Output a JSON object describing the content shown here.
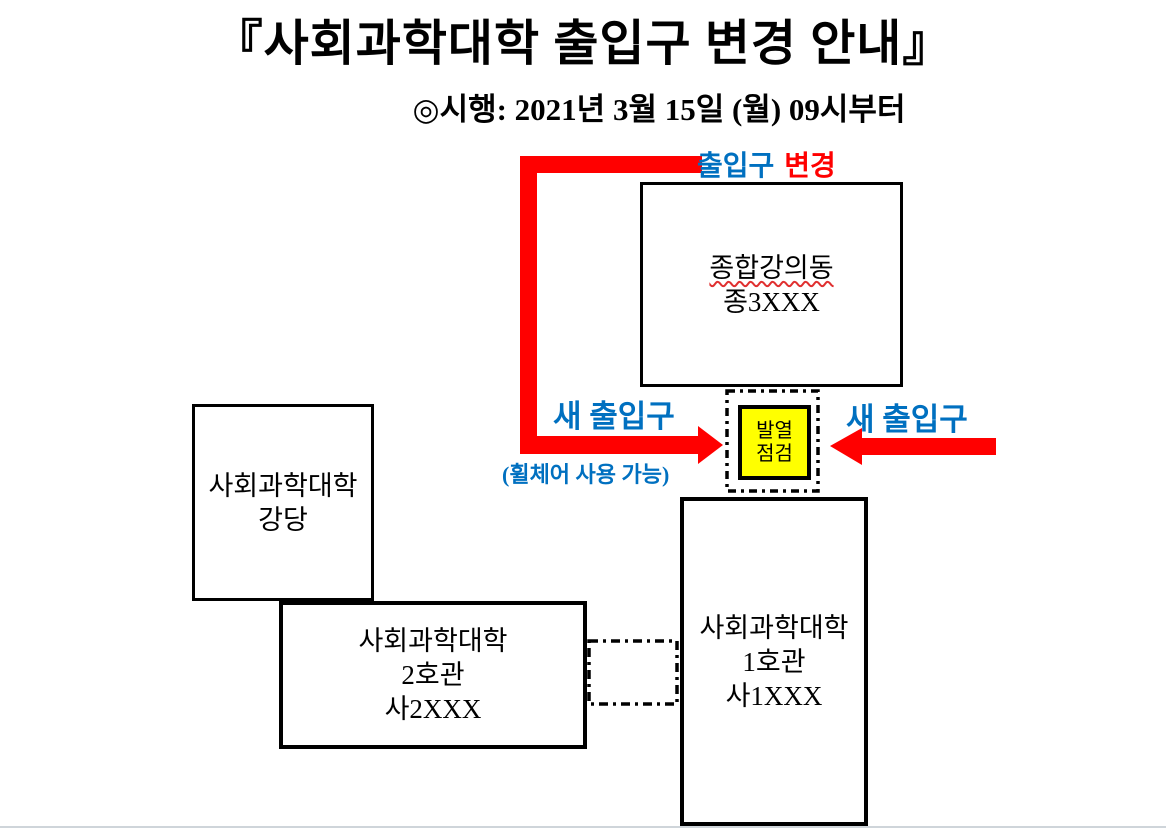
{
  "title": "『사회과학대학 출입구 변경 안내』",
  "subtitle": "◎시행: 2021년 3월 15일 (월) 09시부터",
  "labels": {
    "entrance_change_blue": "출입구",
    "entrance_change_red": "변경",
    "new_entrance_left": "새 출입구",
    "new_entrance_right": "새 출입구",
    "wheelchair_note": "(휠체어 사용 가능)"
  },
  "buildings": {
    "lecture_hall": {
      "name": "종합강의동",
      "code": "종3XXX"
    },
    "auditorium": {
      "line1": "사회과학대학",
      "line2": "강당"
    },
    "building2": {
      "line1": "사회과학대학",
      "line2": "2호관",
      "line3": "사2XXX"
    },
    "building1": {
      "line1": "사회과학대학",
      "line2": "1호관",
      "line3": "사1XXX"
    },
    "checkpoint": {
      "line1": "발열",
      "line2": "점검"
    }
  },
  "colors": {
    "accent_red": "#FF0000",
    "accent_blue": "#0070C0",
    "checkpoint_yellow": "#FFFF00",
    "outline_black": "#000000",
    "page_divider_gray": "#CFD5DA"
  }
}
